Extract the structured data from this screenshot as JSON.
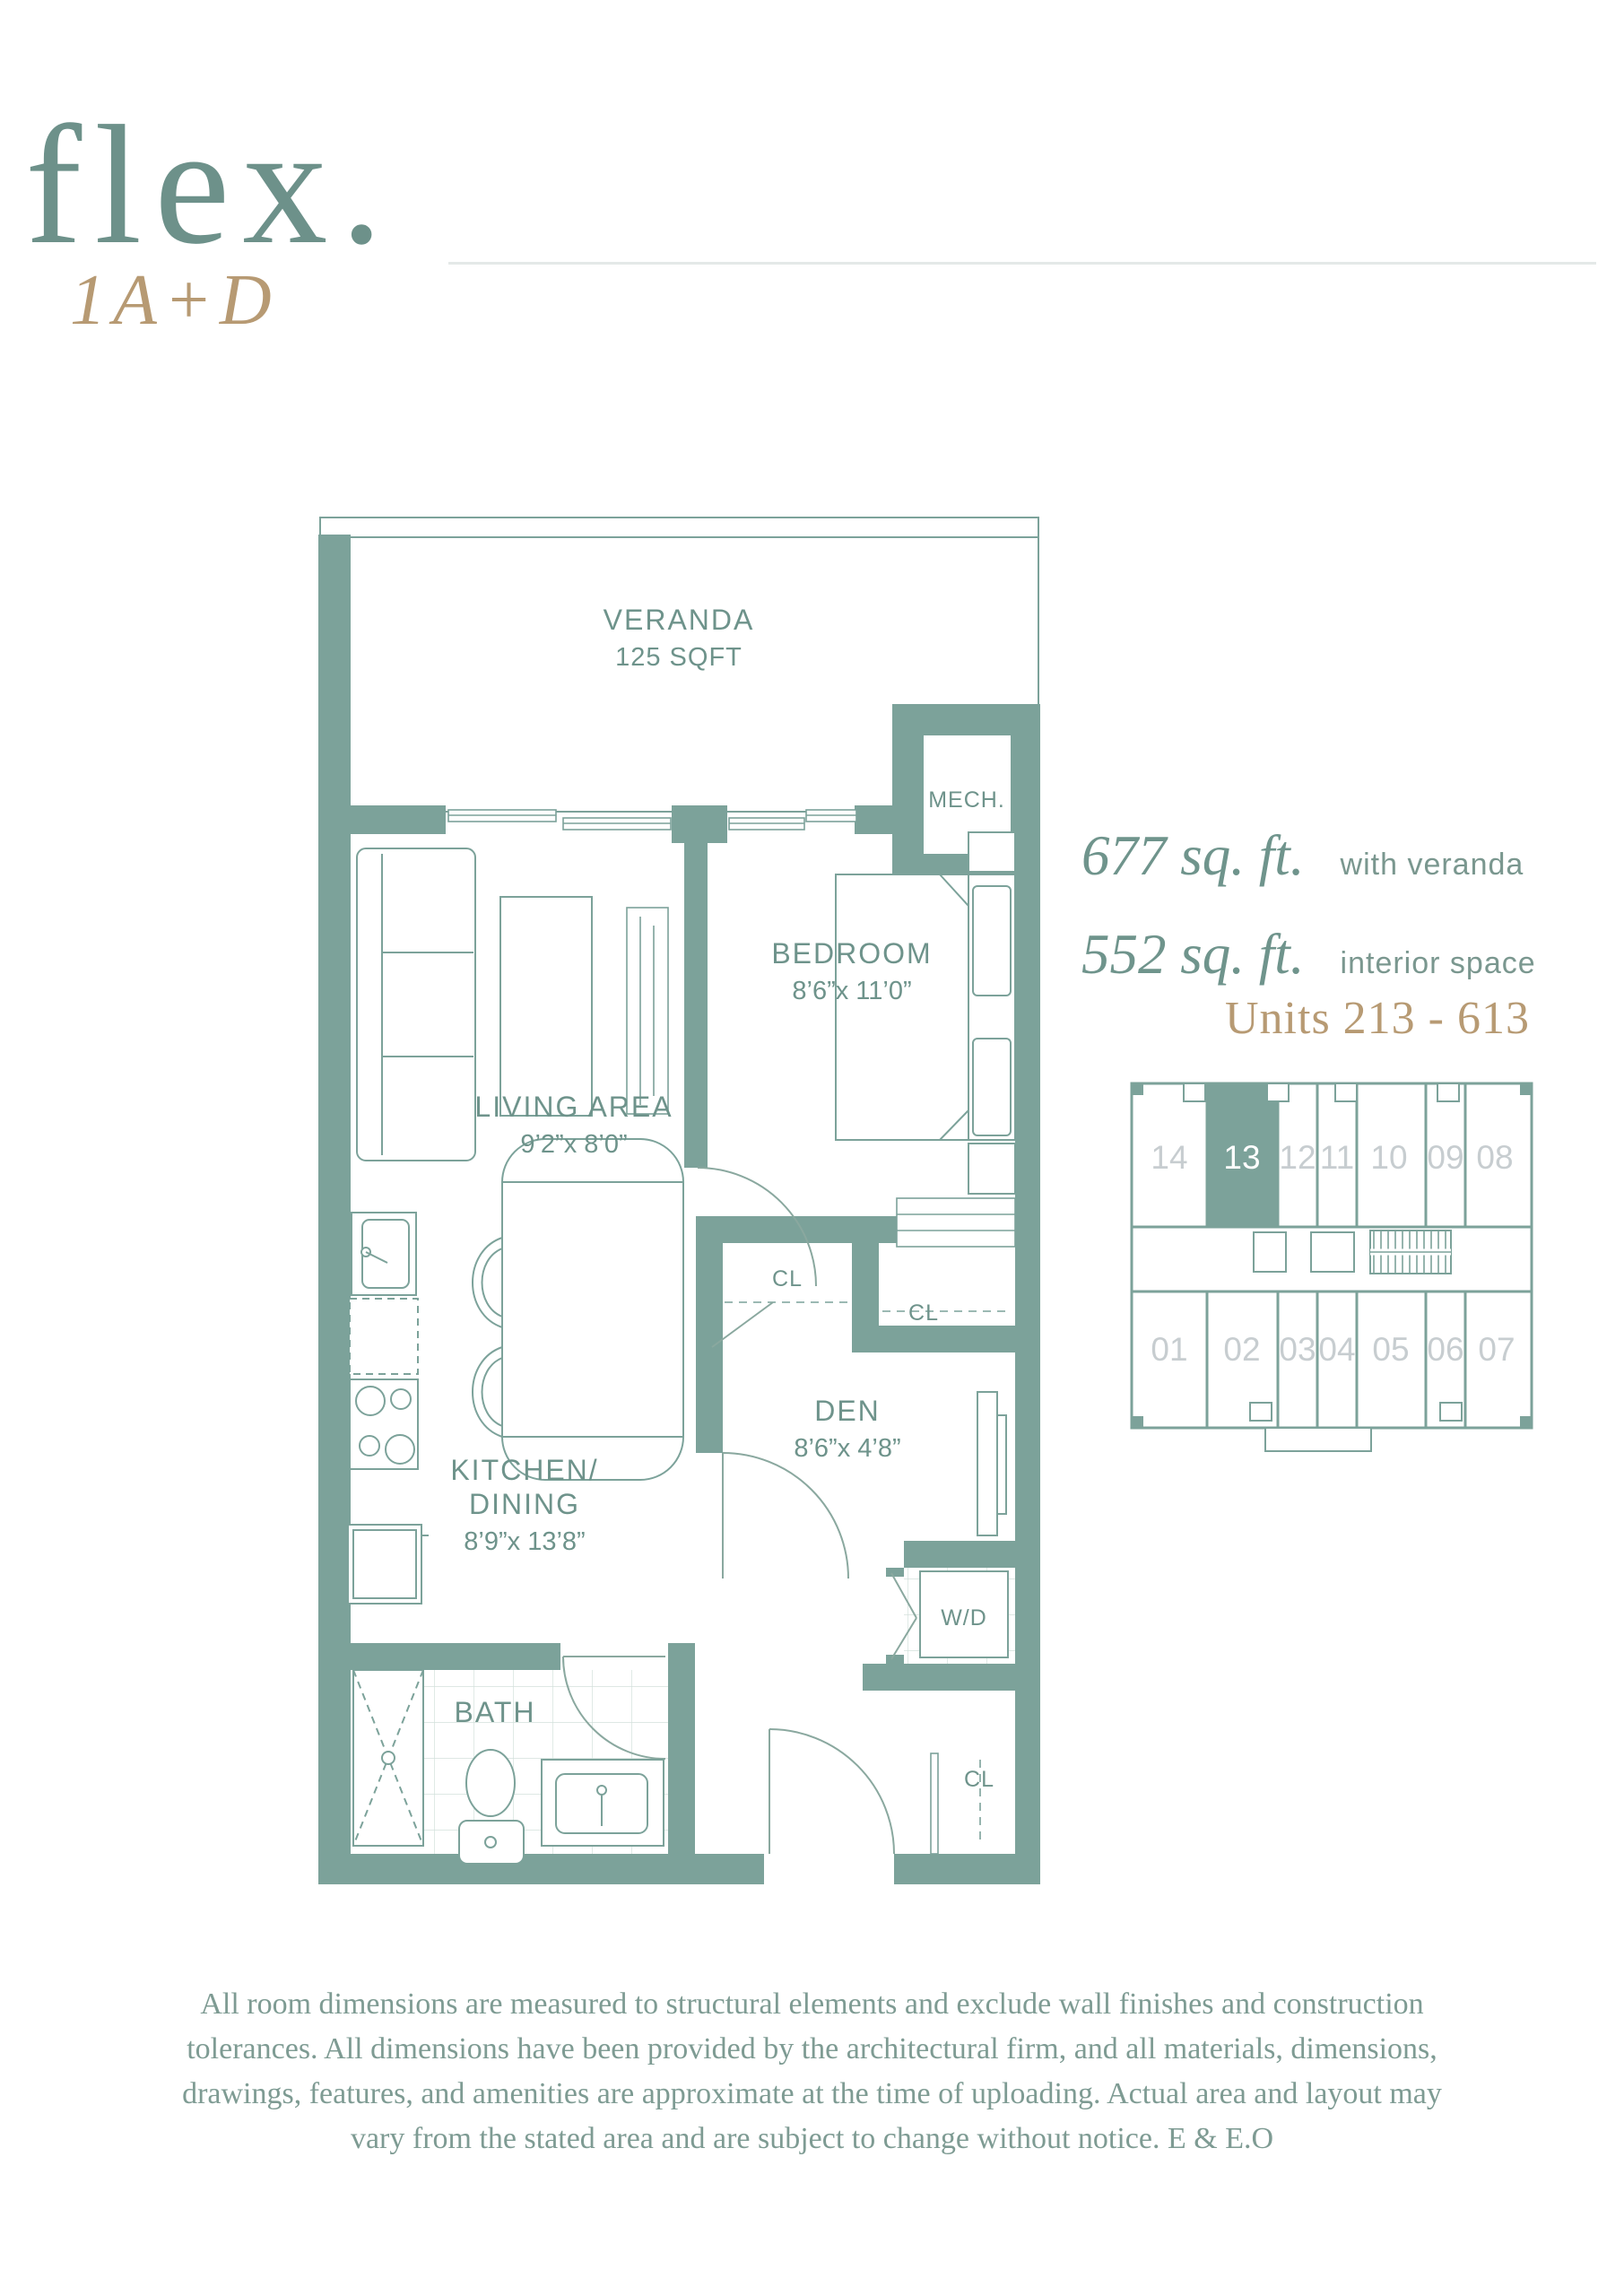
{
  "header": {
    "brand": "flex.",
    "plan_code": "1A+D"
  },
  "areas": {
    "with_veranda": {
      "value": "677 sq. ft.",
      "label": "with veranda"
    },
    "interior": {
      "value": "552 sq. ft.",
      "label": "interior space"
    }
  },
  "units_range": "Units 213 - 613",
  "floor_plan": {
    "veranda": {
      "name": "VERANDA",
      "area": "125 SQFT"
    },
    "mech": {
      "name": "MECH."
    },
    "bedroom": {
      "name": "BEDROOM",
      "dims": "8’6”x 11’0”"
    },
    "living": {
      "name": "LIVING AREA",
      "dims": "9’2”x 8’0”"
    },
    "kitchen": {
      "name_line1": "KITCHEN/",
      "name_line2": "DINING",
      "dims": "8’9”x 13’8”"
    },
    "den": {
      "name": "DEN",
      "dims": "8’6”x 4’8”"
    },
    "bath": {
      "name": "BATH"
    },
    "wd": {
      "name": "W/D"
    },
    "closet1": {
      "name": "CL"
    },
    "closet2": {
      "name": "CL"
    },
    "closet3": {
      "name": "CL"
    }
  },
  "key_plan": {
    "highlighted_unit": "13",
    "top_row": [
      "14",
      "13",
      "12",
      "11",
      "10",
      "09",
      "08"
    ],
    "bottom_row": [
      "01",
      "02",
      "03",
      "04",
      "05",
      "06",
      "07"
    ]
  },
  "disclaimer": {
    "line1": "All room dimensions are measured to structural elements and exclude wall finishes and construction",
    "line2": "tolerances. All dimensions have been provided by the architectural firm, and all materials, dimensions,",
    "line3": "drawings, features, and amenities are approximate at the time of uploading. Actual area and layout may",
    "line4": "vary from the stated area and are subject to change without notice. E & E.O"
  },
  "colors": {
    "wall_teal": "#7ca29a",
    "brand_teal": "#6d918a",
    "label_teal": "#6e938b",
    "gold": "#b79a73",
    "keyplan_number_gray": "#c7cdd0",
    "rule_gray": "#e4e9e8",
    "disclaimer_teal": "#7e9b93"
  }
}
